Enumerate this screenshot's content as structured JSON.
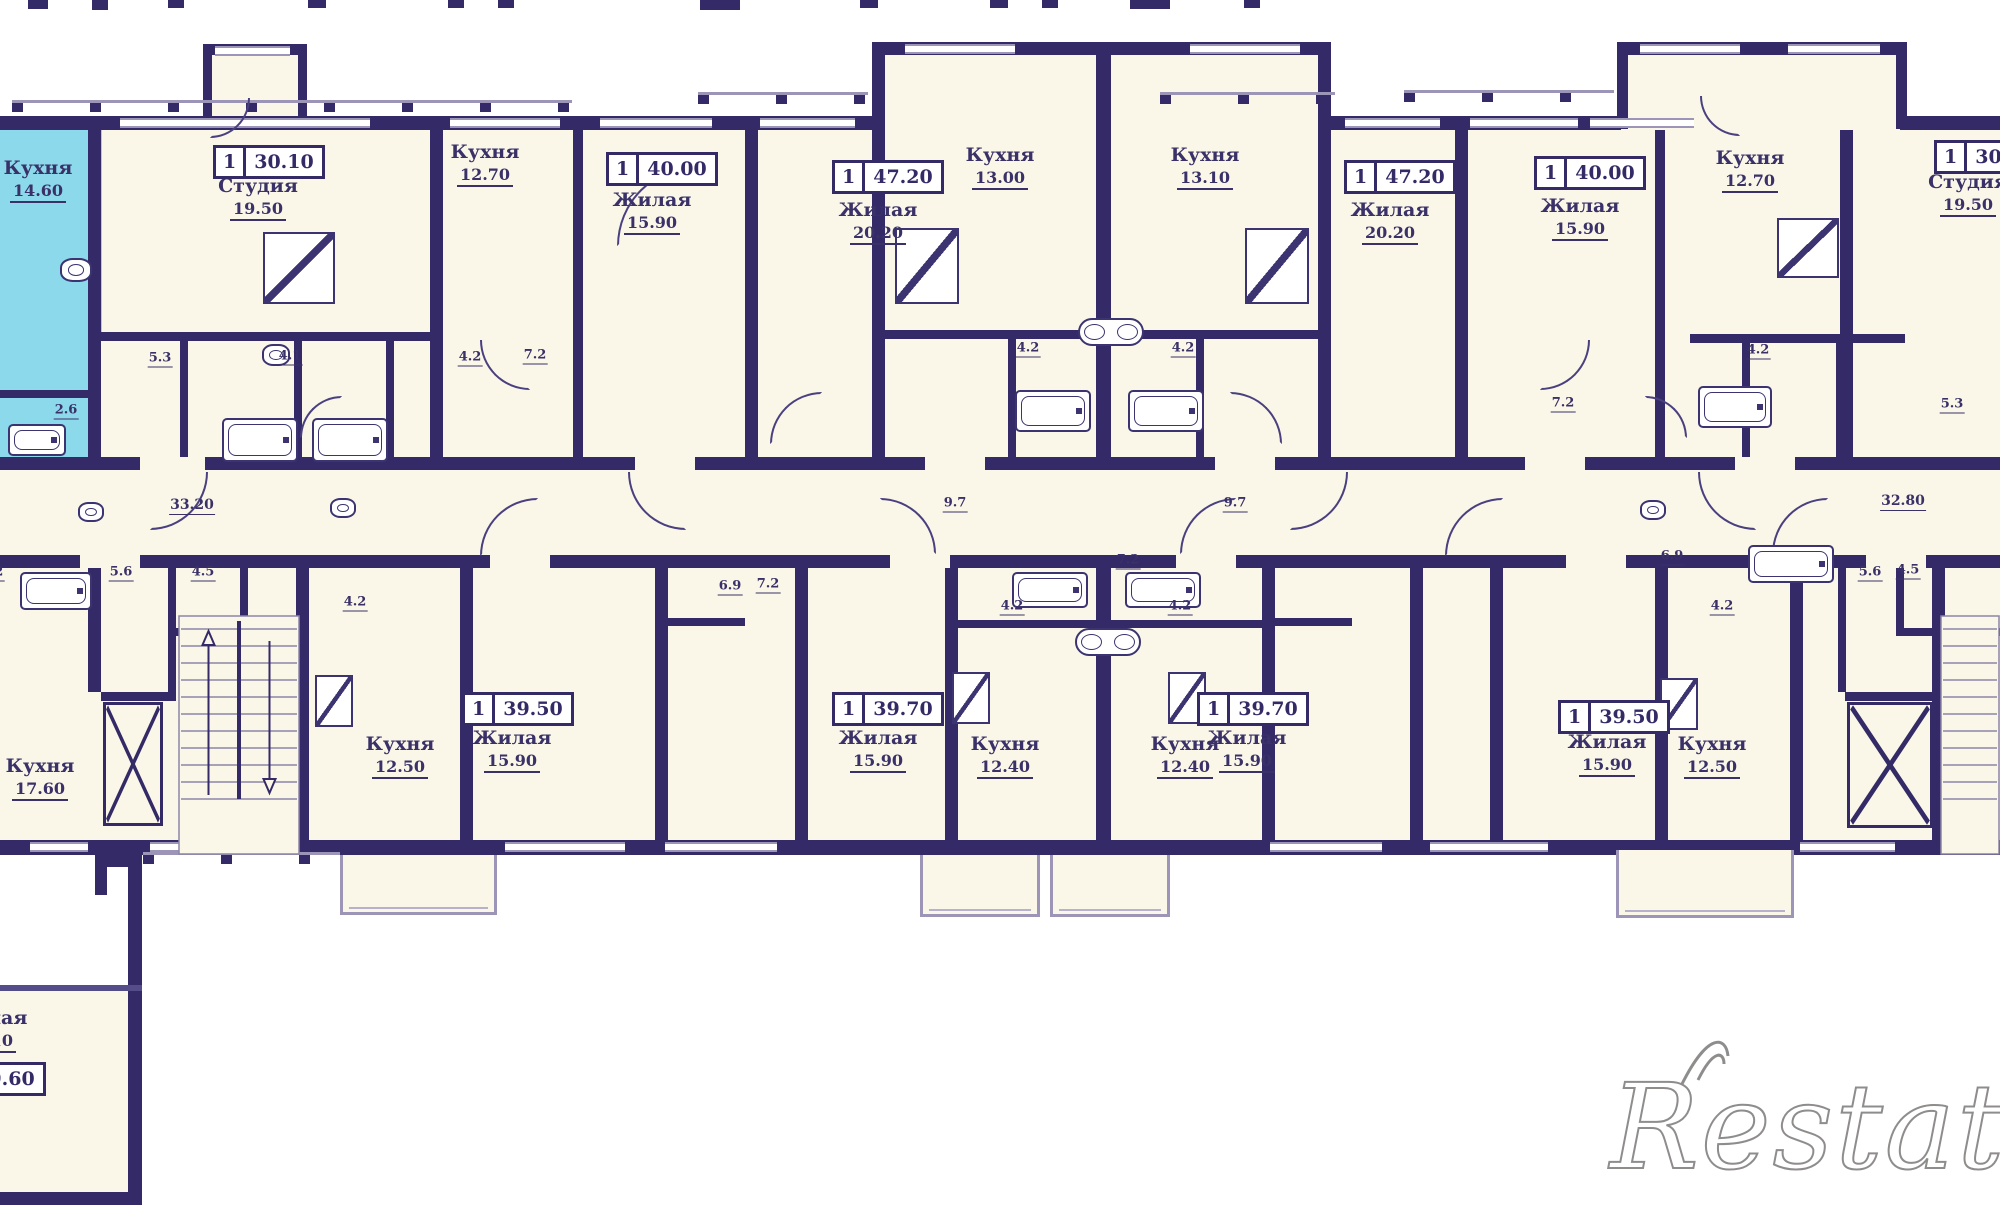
{
  "meta": {
    "type": "apartment-floor-plan",
    "language": "ru",
    "watermark": "Restate"
  },
  "colors": {
    "wall": "#342a68",
    "floor_fill": "#faf6e8",
    "highlight_unit": "#8bd9ea",
    "label_text": "#3a3168",
    "window_line": "#9c95b8",
    "watermark_gray": "#8f8c8c"
  },
  "rooms": [
    {
      "label": "Кухня",
      "area": "14.60",
      "cx": 38,
      "y": 158,
      "note": "highlighted-cyan-unit"
    },
    {
      "label": "Студия",
      "area": "19.50",
      "cx": 258,
      "y": 176
    },
    {
      "label": "Кухня",
      "area": "12.70",
      "cx": 485,
      "y": 142
    },
    {
      "label": "Жилая",
      "area": "15.90",
      "cx": 652,
      "y": 190
    },
    {
      "label": "Жилая",
      "area": "20.20",
      "cx": 878,
      "y": 200
    },
    {
      "label": "Кухня",
      "area": "13.00",
      "cx": 1000,
      "y": 145
    },
    {
      "label": "Кухня",
      "area": "13.10",
      "cx": 1205,
      "y": 145
    },
    {
      "label": "Жилая",
      "area": "20.20",
      "cx": 1390,
      "y": 200
    },
    {
      "label": "Жилая",
      "area": "15.90",
      "cx": 1580,
      "y": 196
    },
    {
      "label": "Кухня",
      "area": "12.70",
      "cx": 1750,
      "y": 148
    },
    {
      "label": "Студия",
      "area": "19.50",
      "cx": 1968,
      "y": 172
    },
    {
      "label": "Кухня",
      "area": "17.60",
      "cx": 40,
      "y": 756
    },
    {
      "label": "Кухня",
      "area": "12.50",
      "cx": 400,
      "y": 734
    },
    {
      "label": "Жилая",
      "area": "15.90",
      "cx": 512,
      "y": 728
    },
    {
      "label": "Жилая",
      "area": "15.90",
      "cx": 878,
      "y": 728
    },
    {
      "label": "Кухня",
      "area": "12.40",
      "cx": 1005,
      "y": 734
    },
    {
      "label": "Кухня",
      "area": "12.40",
      "cx": 1185,
      "y": 734
    },
    {
      "label": "Жилая",
      "area": "15.90",
      "cx": 1247,
      "y": 728
    },
    {
      "label": "Жилая",
      "area": "15.90",
      "cx": 1607,
      "y": 732
    },
    {
      "label": "Кухня",
      "area": "12.50",
      "cx": 1712,
      "y": 734
    },
    {
      "label": "Жилая",
      "area": "20.10",
      "cx": -12,
      "y": 1008,
      "note": "cut-at-left-edge"
    }
  ],
  "badges": [
    {
      "rooms": "1",
      "area": "30.10",
      "cx": 259,
      "y": 145
    },
    {
      "rooms": "1",
      "area": "40.00",
      "cx": 652,
      "y": 152
    },
    {
      "rooms": "1",
      "area": "47.20",
      "cx": 878,
      "y": 160
    },
    {
      "rooms": "1",
      "area": "47.20",
      "cx": 1390,
      "y": 160
    },
    {
      "rooms": "1",
      "area": "40.00",
      "cx": 1580,
      "y": 156
    },
    {
      "rooms": "1",
      "area": "30.10",
      "cx": 1980,
      "y": 140,
      "note": "cut-at-right-edge"
    },
    {
      "rooms": "1",
      "area": "39.50",
      "cx": 508,
      "y": 692
    },
    {
      "rooms": "1",
      "area": "39.70",
      "cx": 878,
      "y": 692
    },
    {
      "rooms": "1",
      "area": "39.70",
      "cx": 1243,
      "y": 692
    },
    {
      "rooms": "1",
      "area": "39.50",
      "cx": 1604,
      "y": 700
    },
    {
      "rooms": "1",
      "area": "39.60",
      "cx": -20,
      "y": 1062,
      "note": "cut-at-left-edge"
    }
  ],
  "dimensions": [
    {
      "v": "2.6",
      "x": 66,
      "y": 410
    },
    {
      "v": "5.3",
      "x": 160,
      "y": 358
    },
    {
      "v": "4.1",
      "x": 290,
      "y": 356
    },
    {
      "v": "4.2",
      "x": 470,
      "y": 357
    },
    {
      "v": "7.2",
      "x": 535,
      "y": 355
    },
    {
      "v": "4.2",
      "x": 1028,
      "y": 348
    },
    {
      "v": "4.2",
      "x": 1183,
      "y": 348
    },
    {
      "v": "7.2",
      "x": 1563,
      "y": 403
    },
    {
      "v": "4.2",
      "x": 1758,
      "y": 350
    },
    {
      "v": "5.3",
      "x": 1952,
      "y": 404
    },
    {
      "v": "33.20",
      "x": 192,
      "y": 505,
      "big": true
    },
    {
      "v": "9.7",
      "x": 955,
      "y": 503
    },
    {
      "v": "9.7",
      "x": 1235,
      "y": 503
    },
    {
      "v": "32.80",
      "x": 1903,
      "y": 501,
      "big": true
    },
    {
      "v": "5.2",
      "x": -8,
      "y": 572
    },
    {
      "v": "5.6",
      "x": 121,
      "y": 572
    },
    {
      "v": "4.5",
      "x": 203,
      "y": 572
    },
    {
      "v": "4.2",
      "x": 355,
      "y": 602
    },
    {
      "v": "6.9",
      "x": 730,
      "y": 586
    },
    {
      "v": "7.2",
      "x": 768,
      "y": 584
    },
    {
      "v": "7.2",
      "x": 1128,
      "y": 560
    },
    {
      "v": "4.2",
      "x": 1012,
      "y": 606
    },
    {
      "v": "4.2",
      "x": 1180,
      "y": 606
    },
    {
      "v": "6.9",
      "x": 1672,
      "y": 556
    },
    {
      "v": "4.2",
      "x": 1722,
      "y": 606
    },
    {
      "v": "5.6",
      "x": 1870,
      "y": 572
    },
    {
      "v": "4.5",
      "x": 1908,
      "y": 570
    }
  ],
  "fixtures": [
    {
      "type": "bathtub-icon",
      "x": 222,
      "y": 418,
      "w": 76,
      "h": 44
    },
    {
      "type": "bathtub-icon",
      "x": 312,
      "y": 418,
      "w": 76,
      "h": 44
    },
    {
      "type": "bathtub-icon",
      "x": 1015,
      "y": 390,
      "w": 76,
      "h": 42
    },
    {
      "type": "bathtub-icon",
      "x": 1128,
      "y": 390,
      "w": 76,
      "h": 42
    },
    {
      "type": "bathtub-icon",
      "x": 1012,
      "y": 572,
      "w": 76,
      "h": 36
    },
    {
      "type": "bathtub-icon",
      "x": 1125,
      "y": 572,
      "w": 76,
      "h": 36
    },
    {
      "type": "bathtub-icon",
      "x": 1698,
      "y": 386,
      "w": 74,
      "h": 42
    },
    {
      "type": "bathtub-icon",
      "x": 1748,
      "y": 545,
      "w": 86,
      "h": 38
    },
    {
      "type": "bathtub-icon",
      "x": 20,
      "y": 572,
      "w": 72,
      "h": 38
    },
    {
      "type": "bathtub-icon",
      "x": 8,
      "y": 424,
      "w": 58,
      "h": 32
    },
    {
      "type": "double-sink-icon",
      "x": 1078,
      "y": 318,
      "w": 66,
      "h": 28
    },
    {
      "type": "double-sink-icon",
      "x": 1075,
      "y": 628,
      "w": 66,
      "h": 28
    },
    {
      "type": "sink-icon",
      "x": 262,
      "y": 344,
      "w": 28,
      "h": 22
    },
    {
      "type": "sink-icon",
      "x": 60,
      "y": 258,
      "w": 32,
      "h": 24
    },
    {
      "type": "sink-icon",
      "x": 78,
      "y": 502,
      "w": 26,
      "h": 20
    },
    {
      "type": "sink-icon",
      "x": 330,
      "y": 498,
      "w": 26,
      "h": 20
    },
    {
      "type": "sink-icon",
      "x": 1640,
      "y": 500,
      "w": 26,
      "h": 20
    },
    {
      "type": "kitchen-icon",
      "x": 263,
      "y": 232,
      "w": 72,
      "h": 72
    },
    {
      "type": "kitchen-icon",
      "x": 895,
      "y": 228,
      "w": 64,
      "h": 76
    },
    {
      "type": "kitchen-icon",
      "x": 1245,
      "y": 228,
      "w": 64,
      "h": 76
    },
    {
      "type": "kitchen-icon",
      "x": 1777,
      "y": 218,
      "w": 62,
      "h": 60
    },
    {
      "type": "kitchen-icon",
      "x": 315,
      "y": 675,
      "w": 38,
      "h": 52
    },
    {
      "type": "kitchen-icon",
      "x": 952,
      "y": 672,
      "w": 38,
      "h": 52
    },
    {
      "type": "kitchen-icon",
      "x": 1168,
      "y": 672,
      "w": 38,
      "h": 52
    },
    {
      "type": "kitchen-icon",
      "x": 1660,
      "y": 678,
      "w": 38,
      "h": 52
    }
  ],
  "features": [
    {
      "type": "stairs",
      "side": "left"
    },
    {
      "type": "stairs",
      "side": "right"
    },
    {
      "type": "elevator",
      "side": "left"
    },
    {
      "type": "elevator",
      "side": "right"
    }
  ]
}
